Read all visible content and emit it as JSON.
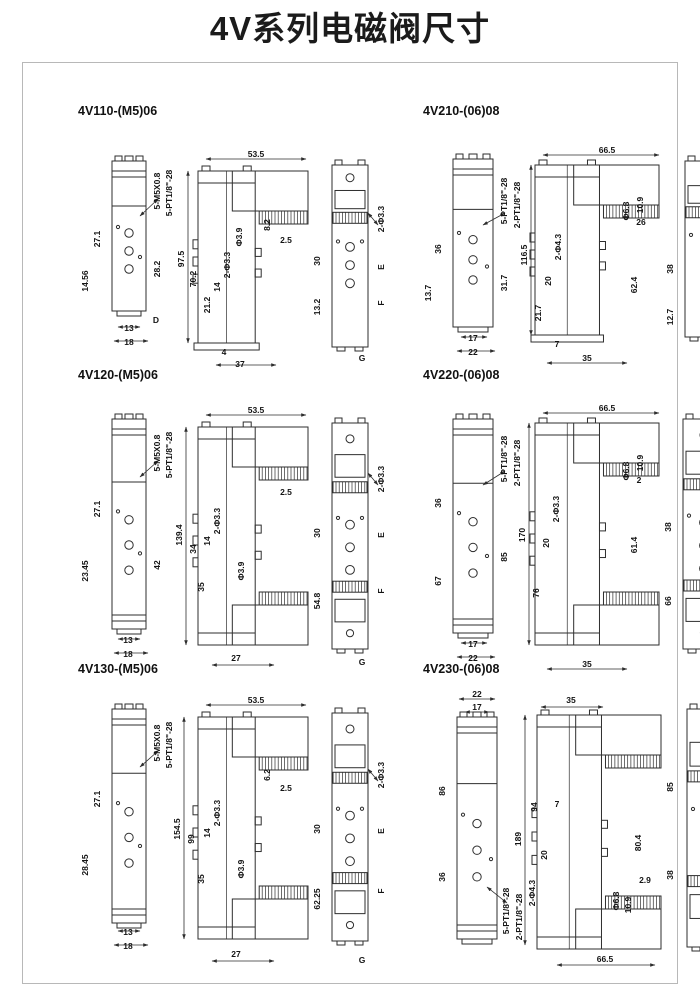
{
  "page": {
    "title": "4V系列电磁阀尺寸"
  },
  "colors": {
    "line": "#2e2e2e",
    "text": "#141414",
    "border": "#b8b8b8",
    "bg": "#ffffff"
  },
  "panels": [
    {
      "title": "4V110-(M5)06",
      "w": 330,
      "h": 252,
      "views": [
        {
          "t": "front",
          "x": 42,
          "y": 42,
          "w": 34,
          "h": 150,
          "d": 0
        },
        {
          "t": "side",
          "x": 128,
          "y": 52,
          "w": 110,
          "h": 172,
          "d": 0
        },
        {
          "t": "back",
          "x": 262,
          "y": 46,
          "w": 36,
          "h": 182,
          "d": 0
        }
      ],
      "labels": [
        {
          "t": "5-M5X0.8",
          "x": 90,
          "y": 72,
          "r": 1
        },
        {
          "t": "5-PT1/8\"-28",
          "x": 102,
          "y": 74,
          "r": 1
        },
        {
          "t": "27.1",
          "x": 30,
          "y": 120,
          "r": 1
        },
        {
          "t": "14.56",
          "x": 18,
          "y": 162,
          "r": 1
        },
        {
          "t": "28.2",
          "x": 90,
          "y": 150,
          "r": 1
        },
        {
          "t": "13",
          "x": 59,
          "y": 212
        },
        {
          "t": "18",
          "x": 59,
          "y": 226
        },
        {
          "t": "D",
          "x": 86,
          "y": 204
        },
        {
          "t": "53.5",
          "x": 186,
          "y": 38
        },
        {
          "t": "97.5",
          "x": 114,
          "y": 140,
          "r": 1
        },
        {
          "t": "70.2",
          "x": 126,
          "y": 160,
          "r": 1
        },
        {
          "t": "21.2",
          "x": 140,
          "y": 186,
          "r": 1
        },
        {
          "t": "14",
          "x": 150,
          "y": 168,
          "r": 1
        },
        {
          "t": "2-Φ3.3",
          "x": 160,
          "y": 146,
          "r": 1
        },
        {
          "t": "Φ3.9",
          "x": 172,
          "y": 118,
          "r": 1
        },
        {
          "t": "8.2",
          "x": 200,
          "y": 106,
          "r": 1
        },
        {
          "t": "2.5",
          "x": 216,
          "y": 124
        },
        {
          "t": "4",
          "x": 154,
          "y": 236
        },
        {
          "t": "37",
          "x": 170,
          "y": 248
        },
        {
          "t": "2-Φ3.3",
          "x": 314,
          "y": 100,
          "r": 1
        },
        {
          "t": "30",
          "x": 250,
          "y": 142,
          "r": 1
        },
        {
          "t": "13.2",
          "x": 250,
          "y": 188,
          "r": 1
        },
        {
          "t": "E",
          "x": 314,
          "y": 148,
          "r": 1
        },
        {
          "t": "F",
          "x": 314,
          "y": 184,
          "r": 1
        },
        {
          "t": "G",
          "x": 292,
          "y": 242
        }
      ],
      "dimlines": [
        [
          136,
          40,
          236,
          40
        ],
        [
          118,
          52,
          118,
          224
        ],
        [
          48,
          208,
          70,
          208
        ],
        [
          44,
          222,
          78,
          222
        ],
        [
          146,
          246,
          206,
          246
        ],
        [
          88,
          80,
          70,
          97
        ],
        [
          308,
          106,
          298,
          94
        ]
      ]
    },
    {
      "title": "4V210-(06)08",
      "w": 330,
      "h": 252,
      "views": [
        {
          "t": "front",
          "x": 38,
          "y": 40,
          "w": 40,
          "h": 168,
          "d": 0
        },
        {
          "t": "side",
          "x": 120,
          "y": 46,
          "w": 124,
          "h": 170,
          "d": 0
        },
        {
          "t": "back",
          "x": 270,
          "y": 42,
          "w": 40,
          "h": 176,
          "d": 0
        }
      ],
      "labels": [
        {
          "t": "5-PT1/8\"-28",
          "x": 92,
          "y": 82,
          "r": 1
        },
        {
          "t": "2-PT1/8\"-28",
          "x": 105,
          "y": 86,
          "r": 1
        },
        {
          "t": "36",
          "x": 26,
          "y": 130,
          "r": 1
        },
        {
          "t": "13.7",
          "x": 16,
          "y": 174,
          "r": 1
        },
        {
          "t": "31.7",
          "x": 92,
          "y": 164,
          "r": 1
        },
        {
          "t": "17",
          "x": 58,
          "y": 222
        },
        {
          "t": "22",
          "x": 58,
          "y": 236
        },
        {
          "t": "66.5",
          "x": 192,
          "y": 34
        },
        {
          "t": "116.5",
          "x": 112,
          "y": 136,
          "r": 1
        },
        {
          "t": "2-Φ4.3",
          "x": 146,
          "y": 128,
          "r": 1
        },
        {
          "t": "20",
          "x": 136,
          "y": 162,
          "r": 1
        },
        {
          "t": "21.7",
          "x": 126,
          "y": 194,
          "r": 1
        },
        {
          "t": "Φ6.8",
          "x": 214,
          "y": 92,
          "r": 1
        },
        {
          "t": "10.9",
          "x": 228,
          "y": 86,
          "r": 1
        },
        {
          "t": "26",
          "x": 226,
          "y": 106
        },
        {
          "t": "62.4",
          "x": 222,
          "y": 166,
          "r": 1
        },
        {
          "t": "7",
          "x": 142,
          "y": 228
        },
        {
          "t": "35",
          "x": 172,
          "y": 242
        },
        {
          "t": "2-Φ3.3",
          "x": 322,
          "y": 104,
          "r": 1
        },
        {
          "t": "38",
          "x": 258,
          "y": 150,
          "r": 1
        },
        {
          "t": "12.7",
          "x": 258,
          "y": 198,
          "r": 1
        },
        {
          "t": "18",
          "x": 322,
          "y": 160,
          "r": 1
        },
        {
          "t": "22.7",
          "x": 322,
          "y": 196,
          "r": 1
        }
      ],
      "dimlines": [
        [
          128,
          36,
          244,
          36
        ],
        [
          116,
          46,
          116,
          216
        ],
        [
          46,
          218,
          72,
          218
        ],
        [
          42,
          232,
          80,
          232
        ],
        [
          132,
          244,
          212,
          244
        ],
        [
          90,
          94,
          68,
          106
        ],
        [
          316,
          110,
          306,
          98
        ]
      ]
    },
    {
      "title": "4V120-(M5)06",
      "w": 330,
      "h": 288,
      "views": [
        {
          "t": "front",
          "x": 42,
          "y": 36,
          "w": 34,
          "h": 210,
          "d": 1
        },
        {
          "t": "side",
          "x": 128,
          "y": 44,
          "w": 110,
          "h": 218,
          "d": 1
        },
        {
          "t": "back",
          "x": 262,
          "y": 40,
          "w": 36,
          "h": 226,
          "d": 1
        }
      ],
      "labels": [
        {
          "t": "5-M5X0.8",
          "x": 90,
          "y": 70,
          "r": 1
        },
        {
          "t": "5-PT1/8\"-28",
          "x": 102,
          "y": 72,
          "r": 1
        },
        {
          "t": "27.1",
          "x": 30,
          "y": 126,
          "r": 1
        },
        {
          "t": "23.45",
          "x": 18,
          "y": 188,
          "r": 1
        },
        {
          "t": "42",
          "x": 90,
          "y": 182,
          "r": 1
        },
        {
          "t": "13",
          "x": 58,
          "y": 260
        },
        {
          "t": "18",
          "x": 58,
          "y": 274
        },
        {
          "t": "53.5",
          "x": 186,
          "y": 30
        },
        {
          "t": "139.4",
          "x": 112,
          "y": 152,
          "r": 1
        },
        {
          "t": "34",
          "x": 126,
          "y": 166,
          "r": 1
        },
        {
          "t": "14",
          "x": 140,
          "y": 158,
          "r": 1
        },
        {
          "t": "2-Φ3.3",
          "x": 150,
          "y": 138,
          "r": 1
        },
        {
          "t": "35",
          "x": 134,
          "y": 204,
          "r": 1
        },
        {
          "t": "2.5",
          "x": 216,
          "y": 112
        },
        {
          "t": "Φ3.9",
          "x": 174,
          "y": 188,
          "r": 1
        },
        {
          "t": "27",
          "x": 166,
          "y": 278
        },
        {
          "t": "2-Φ3.3",
          "x": 314,
          "y": 96,
          "r": 1
        },
        {
          "t": "30",
          "x": 250,
          "y": 150,
          "r": 1
        },
        {
          "t": "54.8",
          "x": 250,
          "y": 218,
          "r": 1
        },
        {
          "t": "E",
          "x": 314,
          "y": 152,
          "r": 1
        },
        {
          "t": "F",
          "x": 314,
          "y": 208,
          "r": 1
        },
        {
          "t": "G",
          "x": 292,
          "y": 282
        }
      ],
      "dimlines": [
        [
          136,
          32,
          236,
          32
        ],
        [
          116,
          44,
          116,
          262
        ],
        [
          48,
          256,
          70,
          256
        ],
        [
          44,
          270,
          78,
          270
        ],
        [
          142,
          282,
          204,
          282
        ],
        [
          88,
          78,
          70,
          94
        ],
        [
          308,
          102,
          298,
          90
        ]
      ]
    },
    {
      "title": "4V220-(06)08",
      "w": 330,
      "h": 288,
      "views": [
        {
          "t": "front",
          "x": 38,
          "y": 36,
          "w": 40,
          "h": 214,
          "d": 1
        },
        {
          "t": "side",
          "x": 120,
          "y": 40,
          "w": 124,
          "h": 222,
          "d": 1
        },
        {
          "t": "back",
          "x": 268,
          "y": 36,
          "w": 42,
          "h": 230,
          "d": 1
        }
      ],
      "labels": [
        {
          "t": "5-PT1/8\"-28",
          "x": 92,
          "y": 76,
          "r": 1
        },
        {
          "t": "2-PT1/8\"-28",
          "x": 105,
          "y": 80,
          "r": 1
        },
        {
          "t": "36",
          "x": 26,
          "y": 120,
          "r": 1
        },
        {
          "t": "67",
          "x": 26,
          "y": 198,
          "r": 1
        },
        {
          "t": "85",
          "x": 92,
          "y": 174,
          "r": 1
        },
        {
          "t": "17",
          "x": 58,
          "y": 264
        },
        {
          "t": "22",
          "x": 58,
          "y": 278
        },
        {
          "t": "66.5",
          "x": 192,
          "y": 28
        },
        {
          "t": "170",
          "x": 110,
          "y": 152,
          "r": 1
        },
        {
          "t": "2-Φ3.3",
          "x": 144,
          "y": 126,
          "r": 1
        },
        {
          "t": "20",
          "x": 134,
          "y": 160,
          "r": 1
        },
        {
          "t": "76",
          "x": 124,
          "y": 210,
          "r": 1
        },
        {
          "t": "Φ6.8",
          "x": 214,
          "y": 88,
          "r": 1
        },
        {
          "t": "10.9",
          "x": 228,
          "y": 80,
          "r": 1
        },
        {
          "t": "2",
          "x": 224,
          "y": 100
        },
        {
          "t": "61.4",
          "x": 222,
          "y": 162,
          "r": 1
        },
        {
          "t": "35",
          "x": 172,
          "y": 284
        },
        {
          "t": "2-Φ3.3",
          "x": 322,
          "y": 94,
          "r": 1
        },
        {
          "t": "38",
          "x": 256,
          "y": 144,
          "r": 1
        },
        {
          "t": "66",
          "x": 256,
          "y": 218,
          "r": 1
        },
        {
          "t": "18",
          "x": 322,
          "y": 158,
          "r": 1
        },
        {
          "t": "76",
          "x": 322,
          "y": 208,
          "r": 1
        }
      ],
      "dimlines": [
        [
          128,
          30,
          244,
          30
        ],
        [
          114,
          40,
          114,
          262
        ],
        [
          46,
          260,
          72,
          260
        ],
        [
          42,
          274,
          80,
          274
        ],
        [
          132,
          286,
          212,
          286
        ],
        [
          90,
          88,
          68,
          102
        ],
        [
          316,
          100,
          306,
          88
        ]
      ]
    },
    {
      "title": "4V130-(M5)06",
      "w": 330,
      "h": 292,
      "views": [
        {
          "t": "front",
          "x": 42,
          "y": 32,
          "w": 34,
          "h": 214,
          "d": 1
        },
        {
          "t": "side",
          "x": 128,
          "y": 40,
          "w": 110,
          "h": 222,
          "d": 1
        },
        {
          "t": "back",
          "x": 262,
          "y": 36,
          "w": 36,
          "h": 228,
          "d": 1
        }
      ],
      "labels": [
        {
          "t": "5-M5X0.8",
          "x": 90,
          "y": 66,
          "r": 1
        },
        {
          "t": "5-PT1/8\"-28",
          "x": 102,
          "y": 68,
          "r": 1
        },
        {
          "t": "27.1",
          "x": 30,
          "y": 122,
          "r": 1
        },
        {
          "t": "28.45",
          "x": 18,
          "y": 188,
          "r": 1
        },
        {
          "t": "13",
          "x": 58,
          "y": 258
        },
        {
          "t": "18",
          "x": 58,
          "y": 272
        },
        {
          "t": "53.5",
          "x": 186,
          "y": 26
        },
        {
          "t": "154.5",
          "x": 110,
          "y": 152,
          "r": 1
        },
        {
          "t": "99",
          "x": 124,
          "y": 162,
          "r": 1
        },
        {
          "t": "14",
          "x": 140,
          "y": 156,
          "r": 1
        },
        {
          "t": "2-Φ3.3",
          "x": 150,
          "y": 136,
          "r": 1
        },
        {
          "t": "35",
          "x": 134,
          "y": 202,
          "r": 1
        },
        {
          "t": "6.2",
          "x": 200,
          "y": 98,
          "r": 1
        },
        {
          "t": "2.5",
          "x": 216,
          "y": 114
        },
        {
          "t": "Φ3.9",
          "x": 174,
          "y": 192,
          "r": 1
        },
        {
          "t": "27",
          "x": 166,
          "y": 280
        },
        {
          "t": "2-Φ3.3",
          "x": 314,
          "y": 98,
          "r": 1
        },
        {
          "t": "30",
          "x": 250,
          "y": 152,
          "r": 1
        },
        {
          "t": "62.25",
          "x": 250,
          "y": 222,
          "r": 1
        },
        {
          "t": "E",
          "x": 314,
          "y": 154,
          "r": 1
        },
        {
          "t": "F",
          "x": 314,
          "y": 214,
          "r": 1
        },
        {
          "t": "G",
          "x": 292,
          "y": 286
        }
      ],
      "dimlines": [
        [
          136,
          28,
          236,
          28
        ],
        [
          114,
          40,
          114,
          262
        ],
        [
          48,
          254,
          70,
          254
        ],
        [
          44,
          268,
          78,
          268
        ],
        [
          142,
          284,
          204,
          284
        ],
        [
          88,
          74,
          70,
          90
        ],
        [
          308,
          104,
          298,
          92
        ]
      ]
    },
    {
      "title": "4V230-(06)08",
      "w": 330,
      "h": 292,
      "views": [
        {
          "t": "front",
          "x": 42,
          "y": 40,
          "w": 40,
          "h": 222,
          "d": 1
        },
        {
          "t": "side",
          "x": 122,
          "y": 38,
          "w": 124,
          "h": 234,
          "d": 1
        },
        {
          "t": "back",
          "x": 272,
          "y": 32,
          "w": 40,
          "h": 238,
          "d": 1
        }
      ],
      "labels": [
        {
          "t": "22",
          "x": 62,
          "y": 20
        },
        {
          "t": "17",
          "x": 62,
          "y": 33
        },
        {
          "t": "86",
          "x": 30,
          "y": 114,
          "r": 1
        },
        {
          "t": "36",
          "x": 30,
          "y": 200,
          "r": 1
        },
        {
          "t": "5-PT1/8\"-28",
          "x": 94,
          "y": 234,
          "r": 1
        },
        {
          "t": "2-PT1/8\"-28",
          "x": 107,
          "y": 240,
          "r": 1
        },
        {
          "t": "35",
          "x": 156,
          "y": 26
        },
        {
          "t": "189",
          "x": 106,
          "y": 162,
          "r": 1
        },
        {
          "t": "94",
          "x": 122,
          "y": 130,
          "r": 1
        },
        {
          "t": "7",
          "x": 142,
          "y": 130
        },
        {
          "t": "20",
          "x": 132,
          "y": 178,
          "r": 1
        },
        {
          "t": "2-Φ4.3",
          "x": 120,
          "y": 216,
          "r": 1
        },
        {
          "t": "Φ6.8",
          "x": 204,
          "y": 224,
          "r": 1
        },
        {
          "t": "10.9",
          "x": 216,
          "y": 228,
          "r": 1
        },
        {
          "t": "2.9",
          "x": 230,
          "y": 206
        },
        {
          "t": "80.4",
          "x": 226,
          "y": 166,
          "r": 1
        },
        {
          "t": "66.5",
          "x": 190,
          "y": 285
        },
        {
          "t": "85",
          "x": 258,
          "y": 110,
          "r": 1
        },
        {
          "t": "38",
          "x": 258,
          "y": 198,
          "r": 1
        },
        {
          "t": "95",
          "x": 322,
          "y": 120,
          "r": 1
        },
        {
          "t": "18",
          "x": 322,
          "y": 186,
          "r": 1
        },
        {
          "t": "2-Φ3.3",
          "x": 322,
          "y": 240,
          "r": 1
        }
      ],
      "dimlines": [
        [
          44,
          22,
          80,
          22
        ],
        [
          50,
          35,
          74,
          35
        ],
        [
          126,
          30,
          188,
          30
        ],
        [
          110,
          38,
          110,
          268
        ],
        [
          142,
          288,
          240,
          288
        ],
        [
          92,
          226,
          72,
          210
        ],
        [
          316,
          242,
          306,
          230
        ]
      ]
    }
  ]
}
